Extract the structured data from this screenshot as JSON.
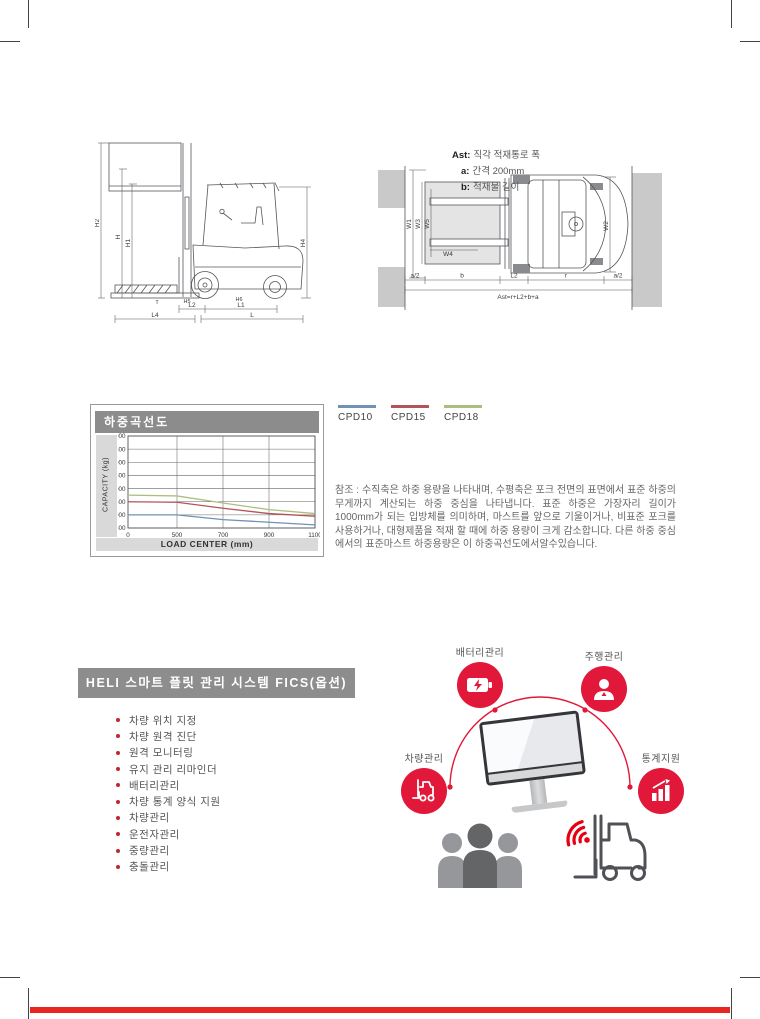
{
  "colors": {
    "accent_red": "#e2183a",
    "wifi_red": "#e60012",
    "banner_gray": "#8d8d8d"
  },
  "side_diagram": {
    "labels": {
      "h2": "H2",
      "h": "H",
      "h1": "H1",
      "h4": "H4",
      "t": "T",
      "h5": "H5",
      "h6": "H6",
      "l2": "L2",
      "l1": "L1",
      "l4": "L4",
      "l": "L"
    }
  },
  "top_diagram": {
    "note": [
      {
        "key": "Ast:",
        "text": "직각 적재통로 폭"
      },
      {
        "key": "a:",
        "text": "간격 200mm"
      },
      {
        "key": "b:",
        "text": "적재물 길이"
      }
    ],
    "labels": {
      "w1": "W1",
      "w3": "W3",
      "w5": "W5",
      "w4": "W4",
      "w2": "W2",
      "a2_left": "a/2",
      "b": "b",
      "l2": "L2",
      "r": "r",
      "a2_right": "a/2",
      "ast": "Ast=r+L2+b+a"
    }
  },
  "chart_data": {
    "type": "line",
    "title": "하중곡선도",
    "xlabel": "LOAD CENTER  (mm)",
    "ylabel": "CAPACITY (kg)",
    "x": [
      0,
      500,
      700,
      900,
      1100
    ],
    "xticks": [
      0,
      500,
      700,
      900,
      1100
    ],
    "ylim": [
      500,
      4000
    ],
    "ytick_step": 500,
    "grid": true,
    "legend_position": "outside-right-top",
    "series": [
      {
        "name": "CPD10",
        "color": "#6f92b5",
        "values": [
          1000,
          1000,
          820,
          720,
          620
        ]
      },
      {
        "name": "CPD15",
        "color": "#b2545a",
        "values": [
          1500,
          1480,
          1250,
          1050,
          950
        ]
      },
      {
        "name": "CPD18",
        "color": "#a9bf7e",
        "values": [
          1750,
          1720,
          1450,
          1200,
          1050
        ]
      }
    ]
  },
  "note_paragraph": "참조 : 수직축은 하중 용량을 나타내며, 수평축은 포크 전면의 표면에서 표준 하중의 무게까지 계산되는 하중 중심을 나타냅니다. 표준 하중은 가장자리 길이가 1000mm가 되는 입방체를 의미하며, 마스트를 앞으로 기울이거나, 비표준 포크를 사용하거나, 대형제품을 적재 할 때에 하중 용량이 크게 감소합니다. 다른 하중 중심에서의 표준마스트 하중용량은 이 하중곡선도에서알수있습니다.",
  "fics": {
    "title": "HELI 스마트 플릿 관리 시스템 FICS(옵션)",
    "features": [
      "차량 위치 지정",
      "차량 원격 진단",
      "원격 모니터링",
      "유지 관리 리마인더",
      "배터리관리",
      "차량 통계 양식 지원",
      "차량관리",
      "운전자관리",
      "중량관리",
      "충돌관리"
    ],
    "nodes": [
      {
        "id": "battery",
        "label": "배터리관리"
      },
      {
        "id": "driving",
        "label": "주행관리"
      },
      {
        "id": "vehicle",
        "label": "차량관리"
      },
      {
        "id": "stats",
        "label": "통계지원"
      }
    ]
  }
}
